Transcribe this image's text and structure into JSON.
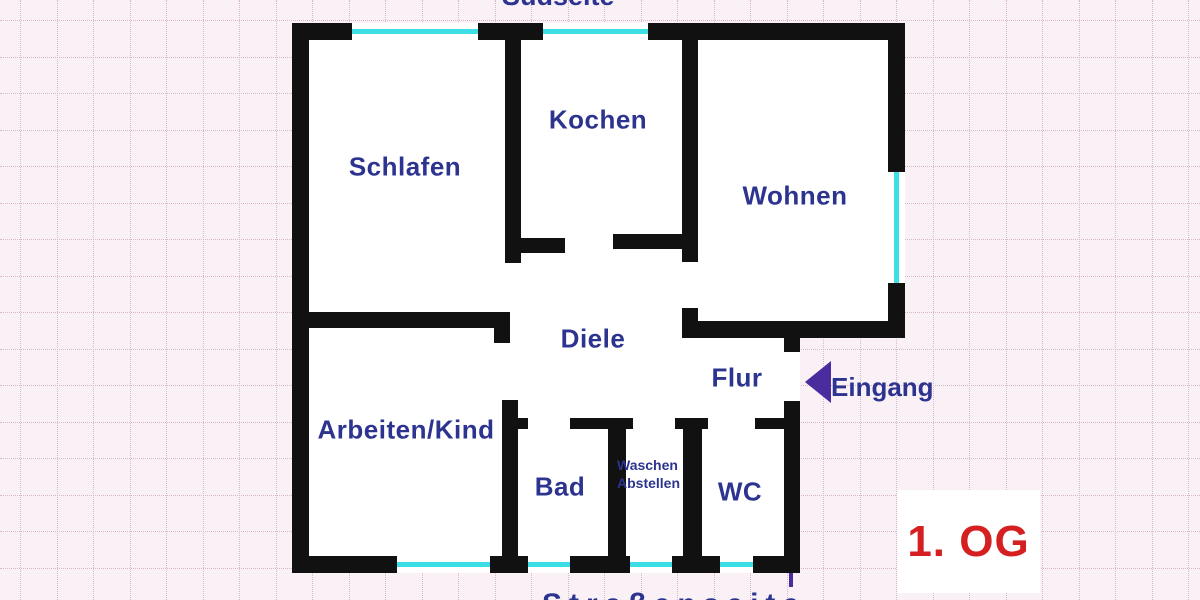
{
  "plan": {
    "side_top": "Südseite",
    "side_bottom": "Straßenseite",
    "entrance": "Eingang",
    "floor": "1. OG",
    "rooms": {
      "schlafen": "Schlafen",
      "kochen": "Kochen",
      "wohnen": "Wohnen",
      "diele": "Diele",
      "flur": "Flur",
      "arbeiten": "Arbeiten/Kind",
      "bad": "Bad",
      "waschen_line1": "Waschen",
      "waschen_line2": "Abstellen",
      "wc": "WC"
    },
    "colors": {
      "wall": "#111111",
      "window": "#3cdfe6",
      "room_label": "#2d3490",
      "entrance_arrow": "#4b2c9e",
      "floor_label": "#d42020",
      "paper": "#f9f1f6",
      "grid": "#d9b8cb"
    }
  }
}
